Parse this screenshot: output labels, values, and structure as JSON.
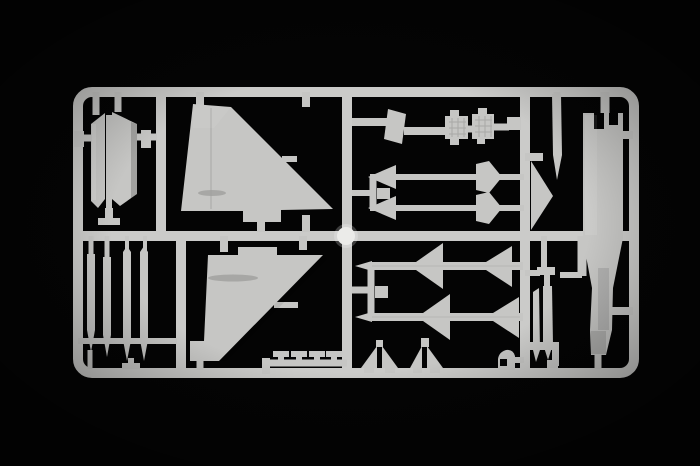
{
  "meta": {
    "media_type": "product-photo",
    "subject": "Injection-molded light grey plastic model kit sprue with aircraft parts on a black background"
  },
  "colors": {
    "background": "#040404",
    "plastic": "#c6c6c4",
    "plastic_frame": "#cbcbc9",
    "plastic_light": "#dcdcda",
    "plastic_dark": "#a7a7a5",
    "detail_line": "#9e9e9c",
    "gate_dot": "#ebebe9"
  },
  "parts": [
    {
      "id": "intake-cover-panels",
      "label": "Curved intake cover panels (pair)"
    },
    {
      "id": "vertical-stabilizer-upper-half",
      "label": "Large vertical tail fin half"
    },
    {
      "id": "intake-ramp-plate",
      "label": "Slanted ramp plate"
    },
    {
      "id": "equipment-boxes",
      "label": "Textured equipment boxes (2)"
    },
    {
      "id": "probe-rail-rods",
      "label": "Long probe/rail rods with arrowheads (2)"
    },
    {
      "id": "triangle-fillet",
      "label": "Triangular fillet part"
    },
    {
      "id": "pitot-blade",
      "label": "Thin pointed pitot blade"
    },
    {
      "id": "fuselage-half",
      "label": "Long fuselage spine half with castellated top"
    },
    {
      "id": "drop-tank-halves",
      "label": "Slim drop tank halves"
    },
    {
      "id": "missiles",
      "label": "Air-to-air missiles with delta fins (2)"
    },
    {
      "id": "missile-tail-fins",
      "label": "Small missile tail fins (4)"
    },
    {
      "id": "curved-hook-part",
      "label": "Small curved part"
    },
    {
      "id": "bracket-clamps",
      "label": "Small I-beam bracket parts (4)"
    },
    {
      "id": "vertical-stabilizer-lower-half",
      "label": "Mirrored vertical tail fin half"
    },
    {
      "id": "gear-door-blades",
      "label": "Thin gear-door / pylon blades (4)"
    },
    {
      "id": "sprue-gate",
      "label": "Bright circular sprue gate boss"
    }
  ]
}
